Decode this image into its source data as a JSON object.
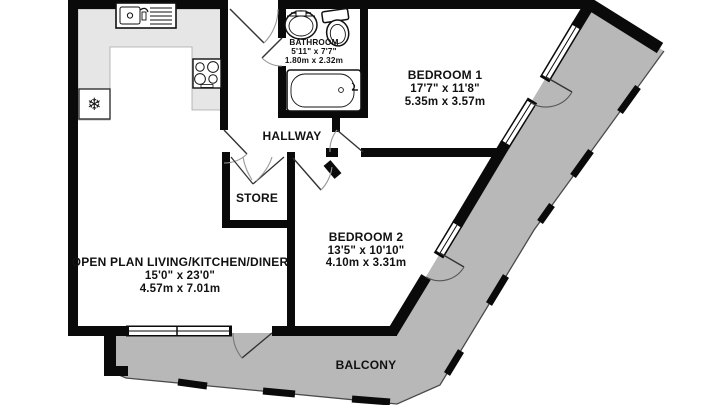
{
  "plan_title": "Apartment floor plan",
  "rooms": {
    "bathroom": {
      "name": "BATHROOM",
      "imperial": "5'11\" x 7'7\"",
      "metric": "1.80m x 2.32m"
    },
    "bedroom1": {
      "name": "BEDROOM 1",
      "imperial": "17'7\" x 11'8\"",
      "metric": "5.35m x 3.57m"
    },
    "bedroom2": {
      "name": "BEDROOM 2",
      "imperial": "13'5\" x 10'10\"",
      "metric": "4.10m x 3.31m"
    },
    "living": {
      "name": "OPEN PLAN LIVING/KITCHEN/DINER",
      "imperial": "15'0\" x 23'0\"",
      "metric": "4.57m x 7.01m"
    },
    "hallway": {
      "name": "HALLWAY"
    },
    "store": {
      "name": "STORE"
    },
    "balcony": {
      "name": "BALCONY"
    }
  },
  "fixtures": {
    "fridge_symbol": "❄",
    "items": [
      "kitchen-sink",
      "hob",
      "fridge-freezer",
      "basin",
      "toilet",
      "bathtub"
    ]
  },
  "colors": {
    "wall": "#0a0a0a",
    "balcony_fill": "#b8b8b8",
    "counter_fill": "#e6e6e6",
    "background": "#ffffff"
  }
}
